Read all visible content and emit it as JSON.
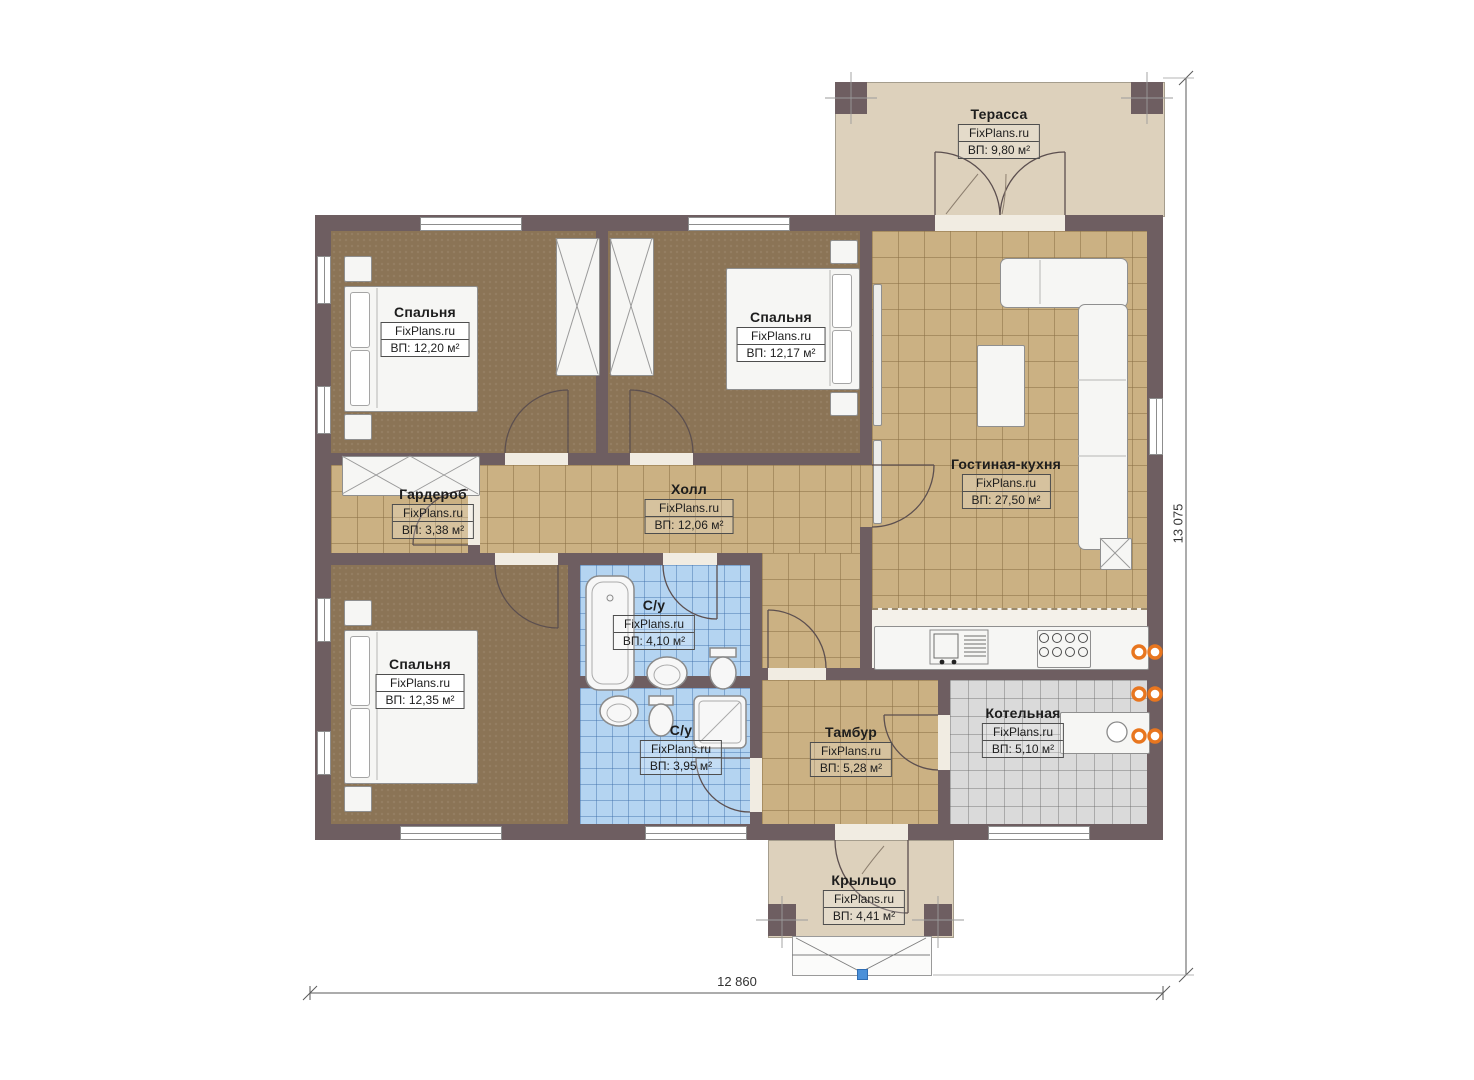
{
  "brand": "FixPlans.ru",
  "rooms": [
    {
      "name": "Терасса",
      "brand": "FixPlans.ru",
      "area": "ВП: 9,80 м²"
    },
    {
      "name": "Спальня",
      "brand": "FixPlans.ru",
      "area": "ВП: 12,20 м²"
    },
    {
      "name": "Спальня",
      "brand": "FixPlans.ru",
      "area": "ВП: 12,17 м²"
    },
    {
      "name": "Гостиная-кухня",
      "brand": "FixPlans.ru",
      "area": "ВП: 27,50 м²"
    },
    {
      "name": "Гардероб",
      "brand": "FixPlans.ru",
      "area": "ВП: 3,38 м²"
    },
    {
      "name": "Холл",
      "brand": "FixPlans.ru",
      "area": "ВП: 12,06 м²"
    },
    {
      "name": "Спальня",
      "brand": "FixPlans.ru",
      "area": "ВП: 12,35 м²"
    },
    {
      "name": "С/у",
      "brand": "FixPlans.ru",
      "area": "ВП: 4,10 м²"
    },
    {
      "name": "С/у",
      "brand": "FixPlans.ru",
      "area": "ВП: 3,95 м²"
    },
    {
      "name": "Тамбур",
      "brand": "FixPlans.ru",
      "area": "ВП: 5,28 м²"
    },
    {
      "name": "Котельная",
      "brand": "FixPlans.ru",
      "area": "ВП: 5,10 м²"
    },
    {
      "name": "Крыльцо",
      "brand": "FixPlans.ru",
      "area": "ВП: 4,41 м²"
    }
  ],
  "dimensions": {
    "width": "12 860",
    "height": "13 075"
  },
  "colors": {
    "wall": "#6e5e61",
    "terrace_floor": "#ddd1bc",
    "bedroom_floor": "#8b7456",
    "tile_floor": "#cbb183",
    "bath_tile": "#b4d4f1",
    "boiler_floor": "#dadada",
    "radiator": "#e8761f",
    "marker": "#4a90d9"
  }
}
